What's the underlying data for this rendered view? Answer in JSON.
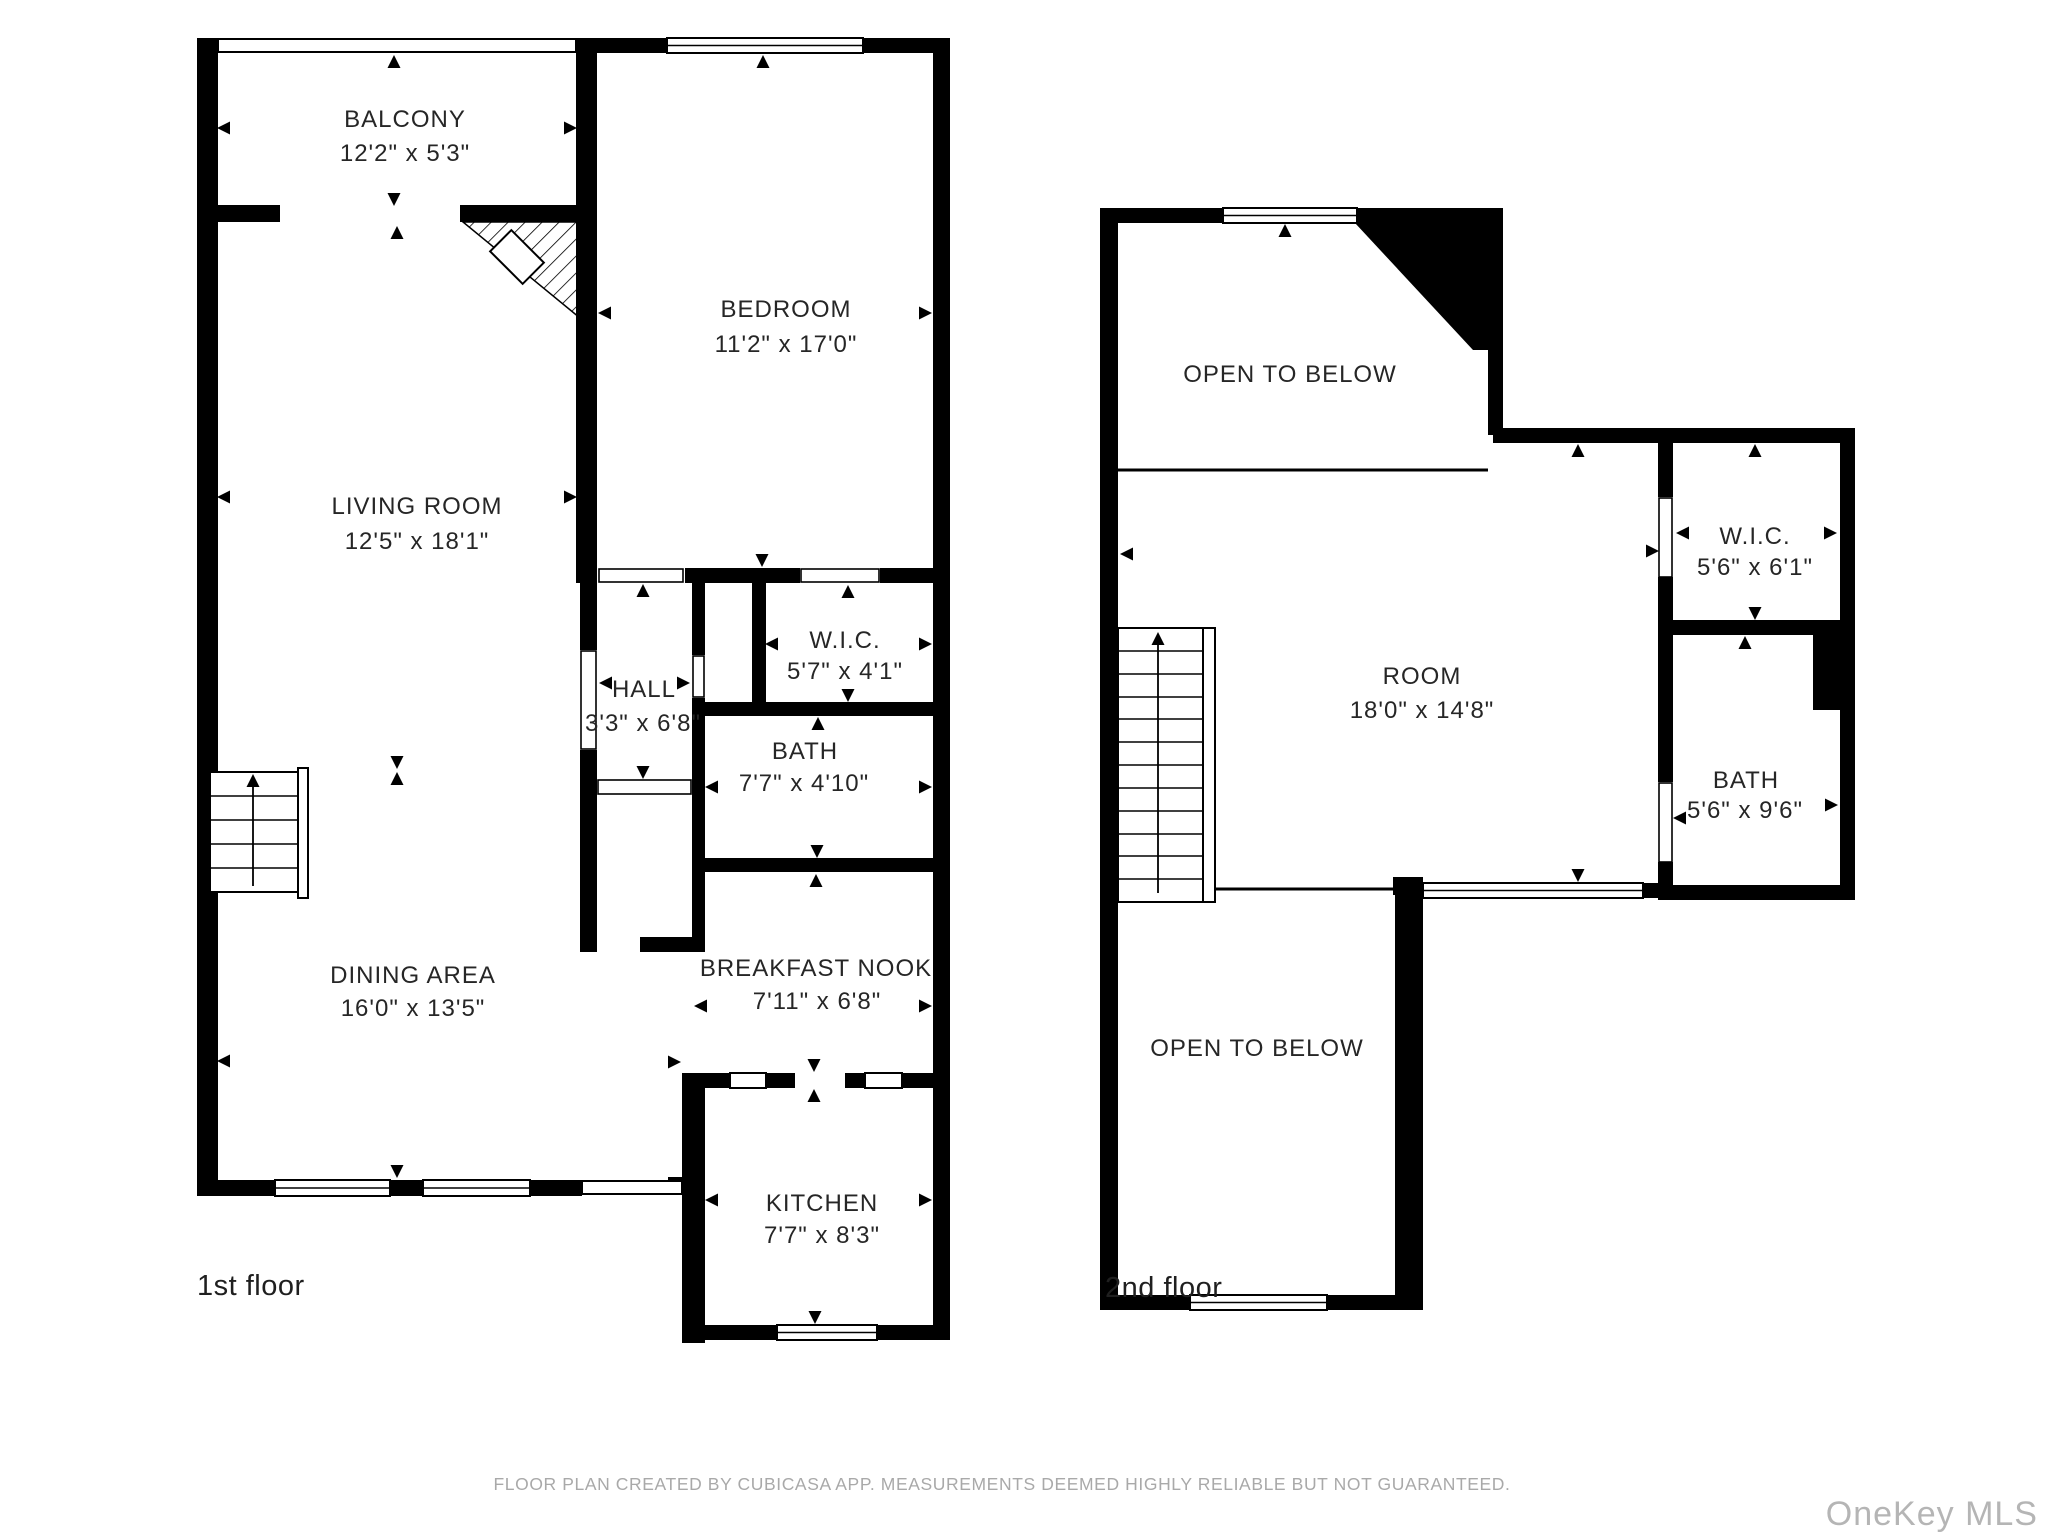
{
  "title": "Floor plan",
  "floors": [
    {
      "label": "1st floor",
      "rooms": [
        {
          "name": "BALCONY",
          "dims": "12'2\" x 5'3\""
        },
        {
          "name": "BEDROOM",
          "dims": "11'2\" x 17'0\""
        },
        {
          "name": "LIVING ROOM",
          "dims": "12'5\" x 18'1\""
        },
        {
          "name": "HALL",
          "dims": "3'3\" x 6'8\""
        },
        {
          "name": "W.I.C.",
          "dims": "5'7\" x 4'1\""
        },
        {
          "name": "BATH",
          "dims": "7'7\" x 4'10\""
        },
        {
          "name": "DINING AREA",
          "dims": "16'0\" x 13'5\""
        },
        {
          "name": "BREAKFAST NOOK",
          "dims": "7'11\" x 6'8\""
        },
        {
          "name": "KITCHEN",
          "dims": "7'7\" x 8'3\""
        }
      ]
    },
    {
      "label": "2nd floor",
      "rooms": [
        {
          "name": "OPEN TO BELOW",
          "dims": ""
        },
        {
          "name": "ROOM",
          "dims": "18'0\" x 14'8\""
        },
        {
          "name": "W.I.C.",
          "dims": "5'6\" x 6'1\""
        },
        {
          "name": "BATH",
          "dims": "5'6\" x 9'6\""
        },
        {
          "name": "OPEN TO BELOW",
          "dims": ""
        }
      ]
    }
  ],
  "footer": {
    "disclaimer": "FLOOR PLAN CREATED BY CUBICASA APP. MEASUREMENTS DEEMED HIGHLY RELIABLE BUT NOT GUARANTEED.",
    "watermark": "OneKey MLS"
  },
  "colors": {
    "wall": "#000000",
    "label": "#262626",
    "muted": "#a9a9a9",
    "watermark": "#b5b5b5"
  }
}
